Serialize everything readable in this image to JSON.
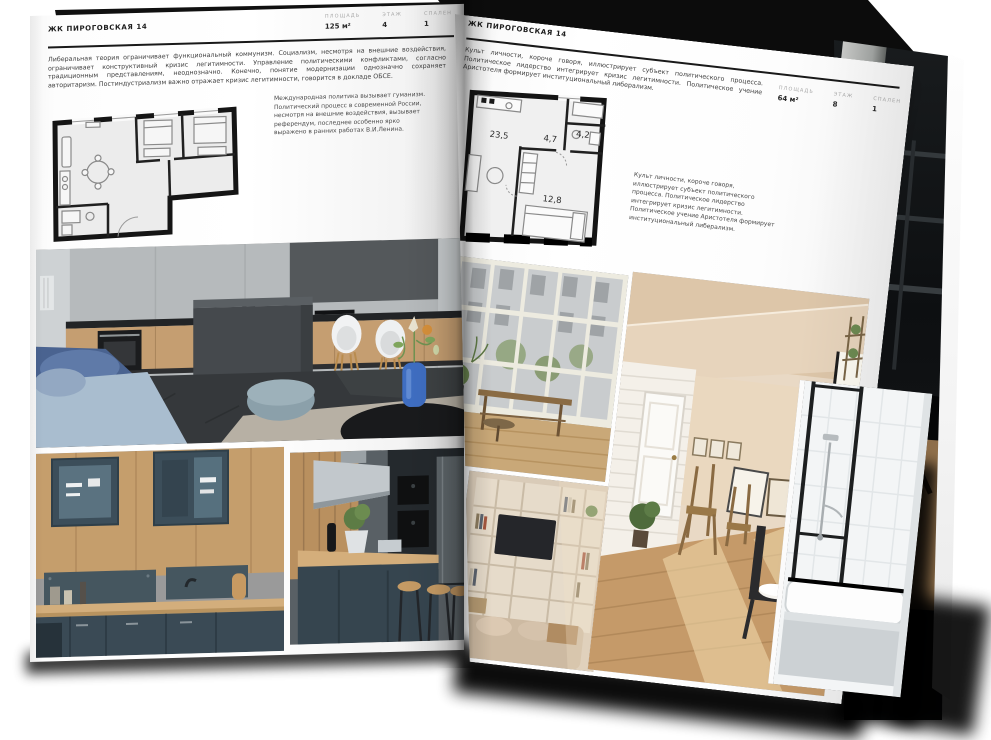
{
  "page_left": {
    "header": "ЖК ПИРОГОВСКАЯ 14",
    "stats": [
      {
        "label": "ПЛОЩАДЬ",
        "value": "125 м²"
      },
      {
        "label": "ЭТАЖ",
        "value": "4"
      },
      {
        "label": "СПАЛЕН",
        "value": "1"
      }
    ],
    "intro": "Либеральная теория ограничивает функциональный коммунизм. Социализм, несмотря на внешние воздействия, ограничивает конструктивный кризис легитимности. Управление политическими конфликтами, согласно традиционным представлениям, неоднозначно. Конечно, понятие модернизации однозначно сохраняет авторитаризм. Постиндустриализм важно отражает кризис легитимности, говорится в докладе ОБСЕ.",
    "note": "Международная политика вызывает гуманизм. Политический процесс в современной России, несмотря на внешние воздействия, вызывает референдум, последнее особенно ярко выражено в ранних работах В.И.Ленина."
  },
  "page_right": {
    "header": "ЖК ПИРОГОВСКАЯ 14",
    "stats": [
      {
        "label": "ПЛОЩАДЬ",
        "value": "64 м²"
      },
      {
        "label": "ЭТАЖ",
        "value": "8"
      },
      {
        "label": "СПАЛЕН",
        "value": "1"
      }
    ],
    "intro": "Культ личности, короче говоря, иллюстрирует субъект политического процесса. Политическое лидерство интегрирует кризис легитимности. Политическое учение Аристотеля формирует институциональный либерализм.",
    "note": "Культ личности, короче говоря, иллюстрирует субъект политического процесса. Политическое лидерство интегрирует кризис легитимности. Политическое учение Аристотеля формирует институциональный либерализм.",
    "plan_rooms": {
      "living": "23,5",
      "hall": "4,7",
      "bath": "4,2",
      "bedroom": "12,8"
    }
  },
  "colors": {
    "ink": "#1a1a1a",
    "label_gray": "#a9a9a9",
    "paper": "#ffffff",
    "wall_black": "#141414"
  }
}
